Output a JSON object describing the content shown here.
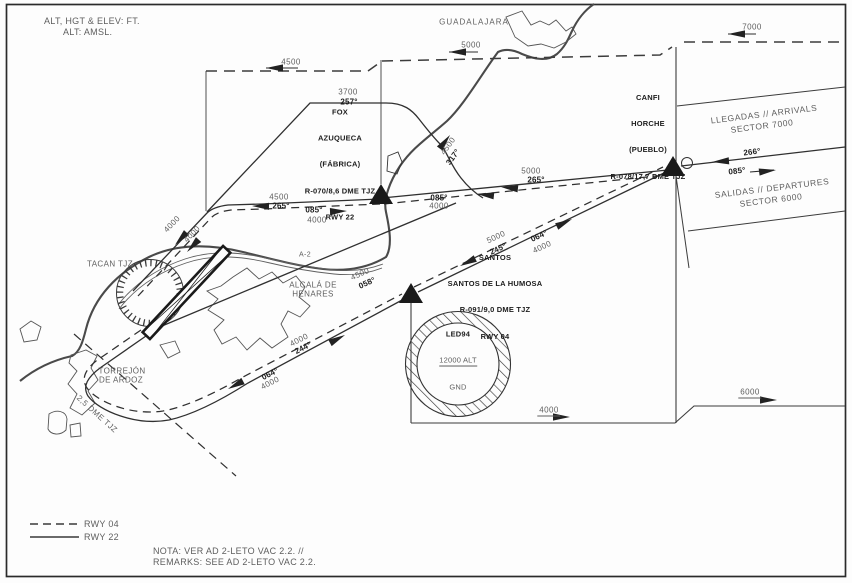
{
  "header": {
    "units1": "ALT, HGT & ELEV: FT.",
    "units2": "ALT: AMSL."
  },
  "places": {
    "guadalajara": "GUADALAJARA",
    "alcala1": "ALCALÁ DE",
    "alcala2": "HENARES",
    "torrejon1": "TORREJÓN",
    "torrejon2": "DE ARDOZ",
    "road_a2": "A-2"
  },
  "navaids": {
    "tacan": "TACAN TJZ",
    "dme_ring": "2,5 DME TJZ"
  },
  "waypoints": {
    "fox": {
      "l1": "FOX",
      "l2": "AZUQUECA",
      "l3": "(FÁBRICA)",
      "l4": "R-070/8,6 DME TJZ",
      "l5": "RWY 22"
    },
    "canfi": {
      "l1": "CANFI",
      "l2": "HORCHE",
      "l3": "(PUEBLO)",
      "l4": "R-078/17,7 DME TJZ"
    },
    "santos": {
      "l1": "SANTOS",
      "l2": "SANTOS DE LA HUMOSA",
      "l3": "R-091/9,0 DME TJZ",
      "l4": "RWY 04"
    }
  },
  "restricted": {
    "id": "LED94",
    "top": "12000 ALT",
    "bottom": "GND"
  },
  "sectors": {
    "arr1": "LLEGADAS // ARRIVALS",
    "arr2": "SECTOR 7000",
    "dep1": "SALIDAS // DEPARTURES",
    "dep2": "SECTOR 6000"
  },
  "levels": {
    "tl4500": "4500",
    "top5000": "5000",
    "tr7000": "7000",
    "dep3700": "3700",
    "fox_w_4500": "4500",
    "fox_w_4000": "4000",
    "fox_e_5000": "5000",
    "fox_e_4000": "4000",
    "climb4500": "4500",
    "rwy4000a": "4000",
    "rwy4000b": "4000",
    "l058_4500": "4500",
    "sw4000a": "4000",
    "sw4000b": "4000",
    "ne5000": "5000",
    "ne4000": "4000",
    "br4000": "4000",
    "br6000": "6000"
  },
  "headings": {
    "dep257": "257°",
    "w265": "265°",
    "w085": "085°",
    "e265": "265°",
    "e085": "085°",
    "climb317": "317°",
    "l058": "058°",
    "sw244": "244°",
    "sw064": "064°",
    "ne245": "245°",
    "ne064": "064°",
    "in266": "266°",
    "out085": "085°"
  },
  "legend": {
    "dashed": "RWY 04",
    "solid": "RWY 22"
  },
  "notes": {
    "l1": "NOTA: VER AD 2-LETO VAC 2.2. //",
    "l2": "REMARKS: SEE AD 2-LETO VAC 2.2."
  }
}
